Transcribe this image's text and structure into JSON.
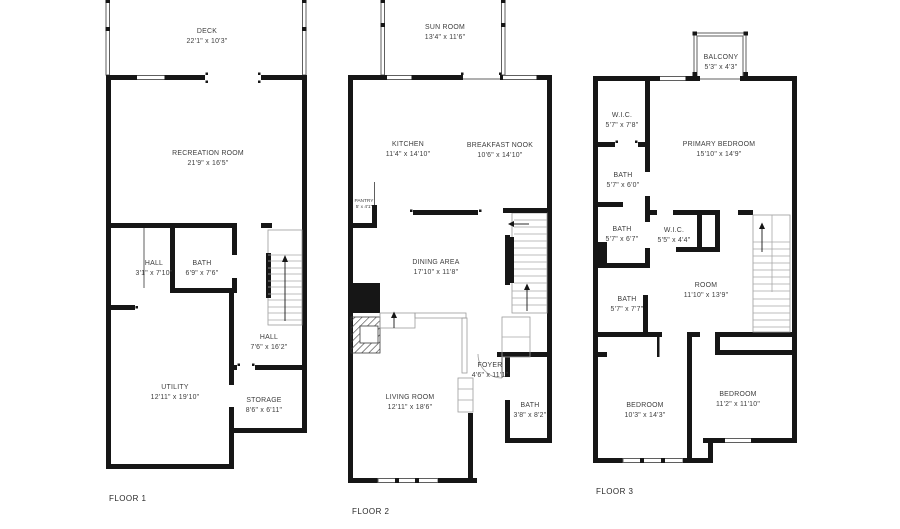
{
  "colors": {
    "wall": "#161616",
    "thin_line": "#5f5f5f",
    "stair_line": "#a8a8a8",
    "text": "#3d3d3d",
    "background": "#ffffff"
  },
  "floors": [
    {
      "label": "FLOOR 1",
      "rooms": [
        {
          "name": "DECK",
          "dims": "22'1\" x 10'3\""
        },
        {
          "name": "RECREATION ROOM",
          "dims": "21'9\" x 16'5\""
        },
        {
          "name": "HALL",
          "dims": "3'1\" x 7'10\""
        },
        {
          "name": "BATH",
          "dims": "6'9\" x 7'6\""
        },
        {
          "name": "HALL",
          "dims": "7'6\" x 16'2\""
        },
        {
          "name": "UTILITY",
          "dims": "12'11\" x 19'10\""
        },
        {
          "name": "STORAGE",
          "dims": "8'6\" x 6'11\""
        }
      ]
    },
    {
      "label": "FLOOR 2",
      "rooms": [
        {
          "name": "SUN ROOM",
          "dims": "13'4\" x 11'6\""
        },
        {
          "name": "KITCHEN",
          "dims": "11'4\" x 14'10\""
        },
        {
          "name": "BREAKFAST NOOK",
          "dims": "10'6\" x 14'10\""
        },
        {
          "name": "PANTRY",
          "dims": "5' x 4'1\""
        },
        {
          "name": "DINING AREA",
          "dims": "17'10\" x 11'8\""
        },
        {
          "name": "LIVING ROOM",
          "dims": "12'11\" x 18'6\""
        },
        {
          "name": "FOYER",
          "dims": "4'6\" x 11'1\""
        },
        {
          "name": "BATH",
          "dims": "3'8\" x 8'2\""
        }
      ]
    },
    {
      "label": "FLOOR 3",
      "rooms": [
        {
          "name": "BALCONY",
          "dims": "5'3\" x 4'3\""
        },
        {
          "name": "W.I.C.",
          "dims": "5'7\" x 7'8\""
        },
        {
          "name": "PRIMARY BEDROOM",
          "dims": "15'10\" x 14'9\""
        },
        {
          "name": "BATH",
          "dims": "5'7\" x 6'0\""
        },
        {
          "name": "BATH",
          "dims": "5'7\" x 6'7\""
        },
        {
          "name": "W.I.C.",
          "dims": "5'5\" x 4'4\""
        },
        {
          "name": "ROOM",
          "dims": "11'10\" x 13'9\""
        },
        {
          "name": "BATH",
          "dims": "5'7\" x 7'7\""
        },
        {
          "name": "BEDROOM",
          "dims": "10'3\" x 14'3\""
        },
        {
          "name": "BEDROOM",
          "dims": "11'2\" x 11'10\""
        }
      ]
    }
  ]
}
